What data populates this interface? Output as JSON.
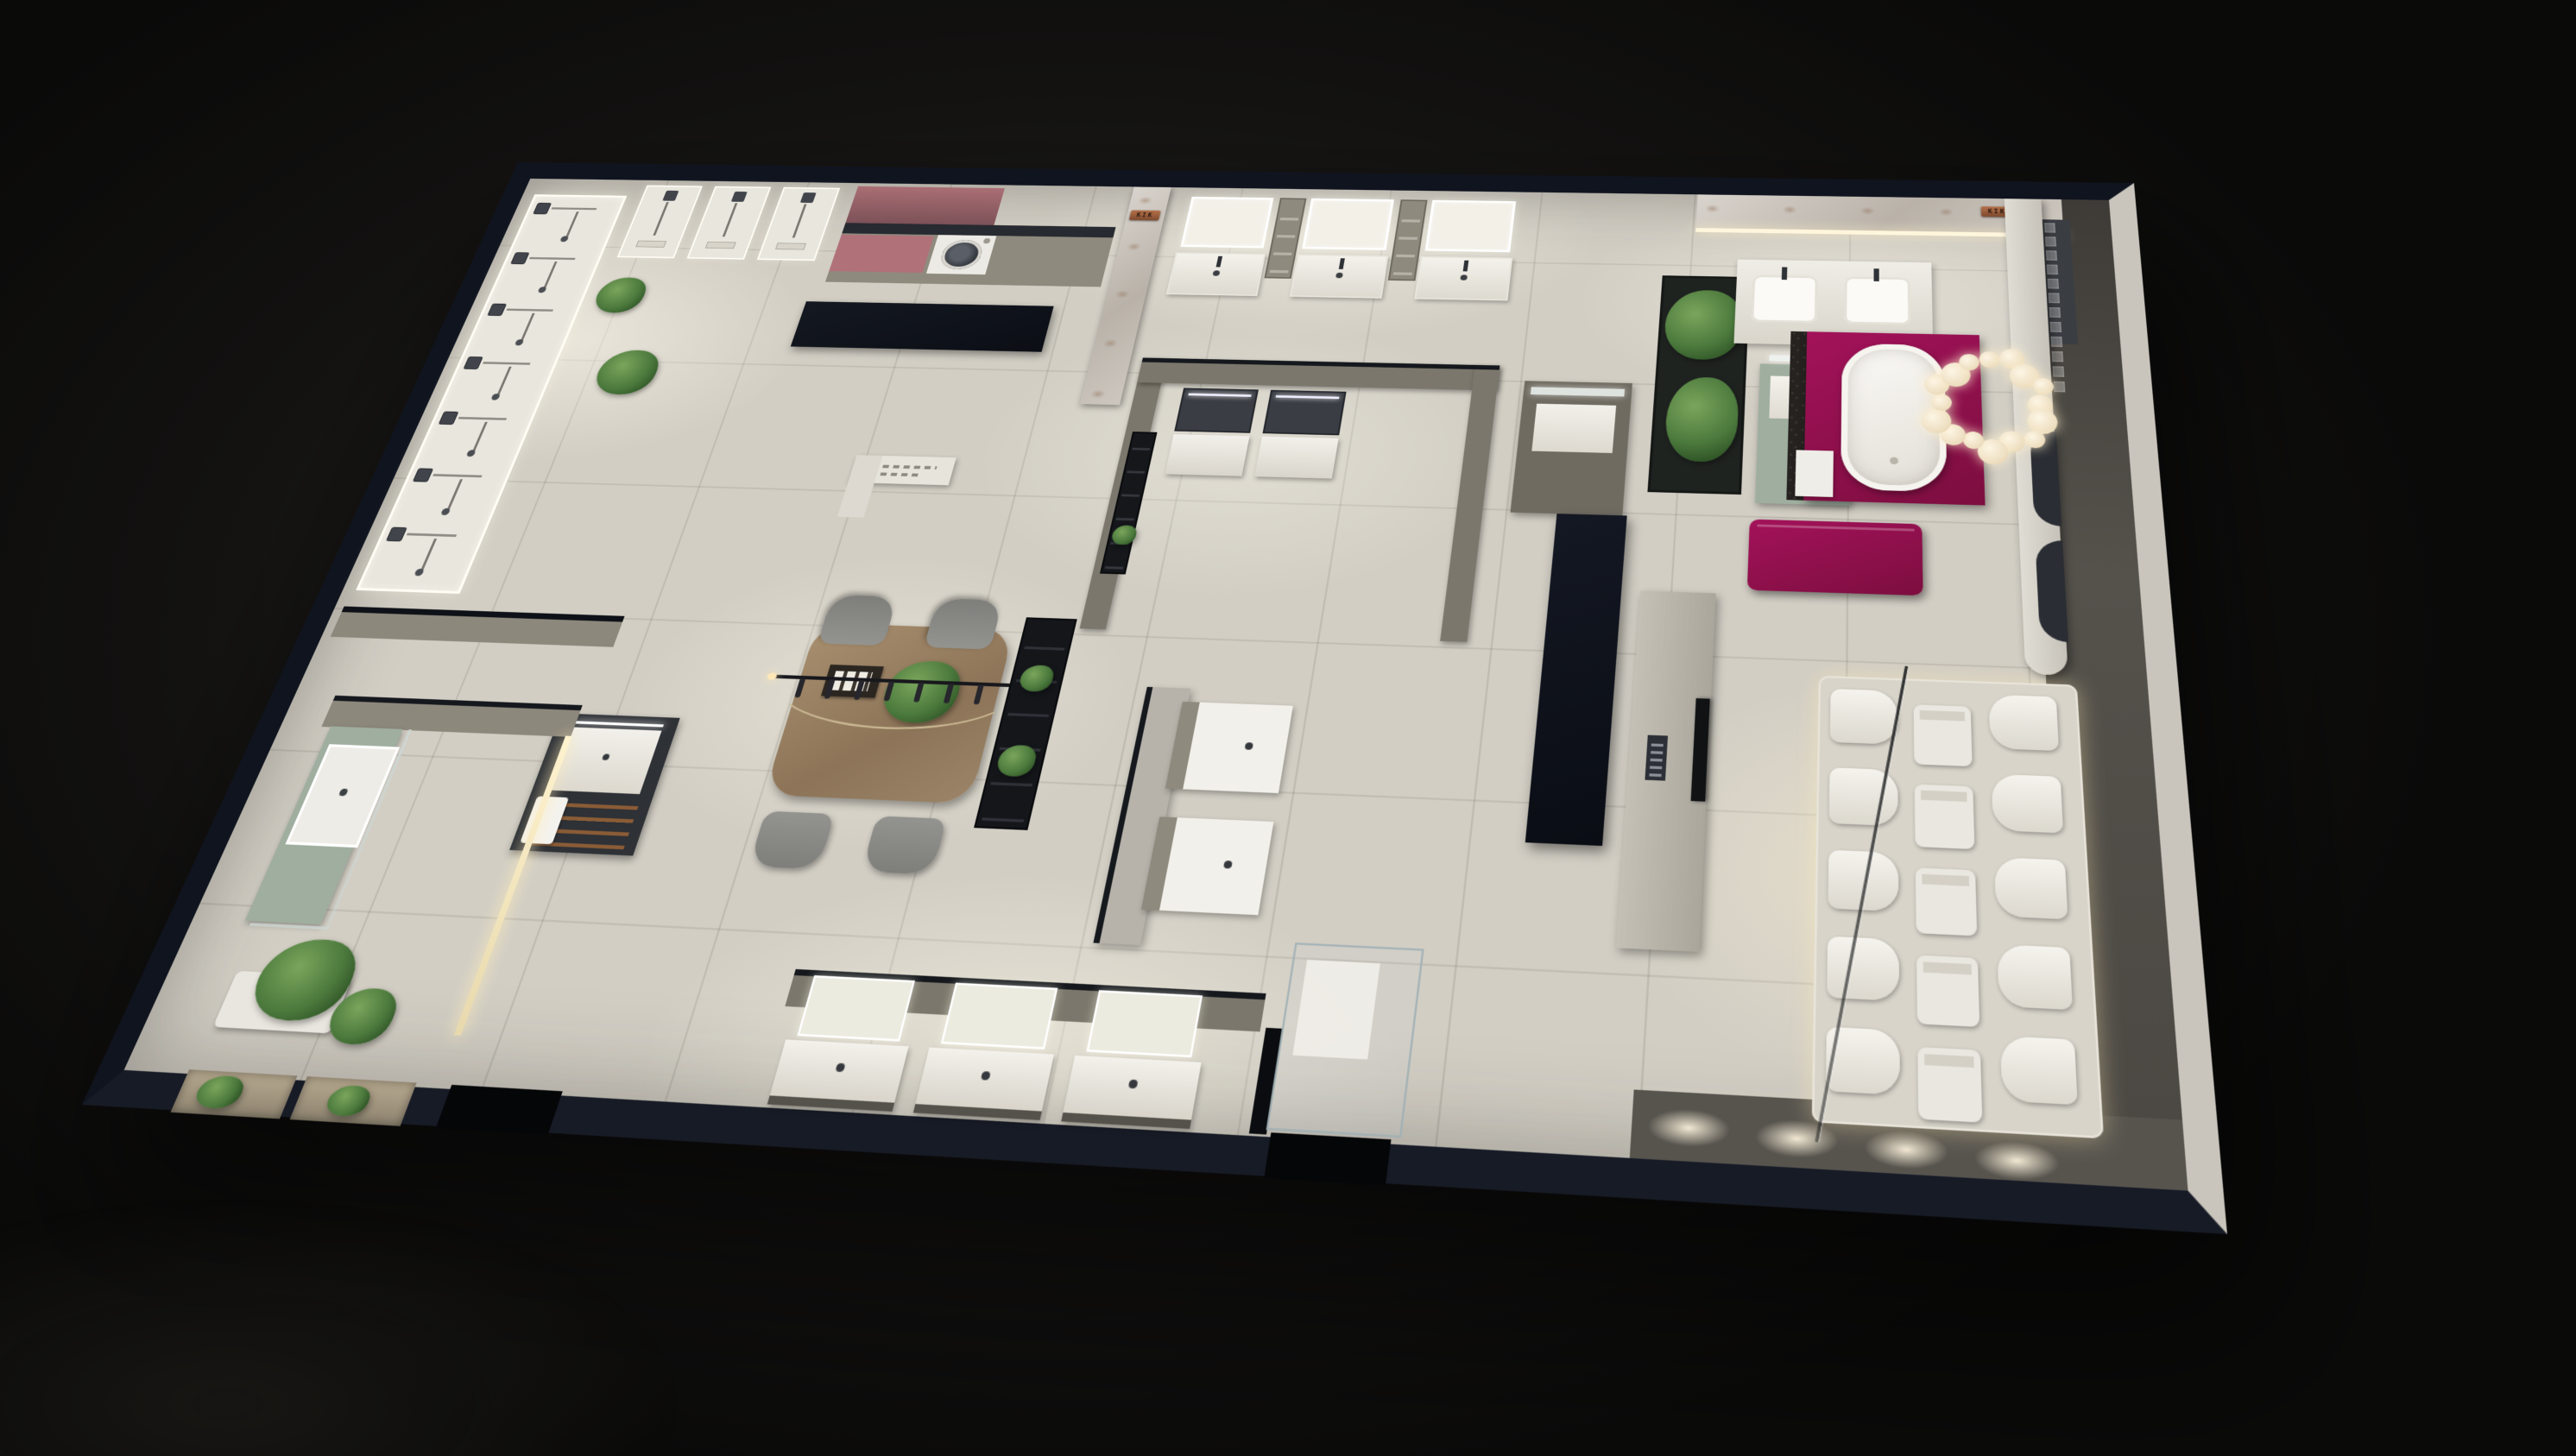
{
  "scene": {
    "description": "Top-down 3D night render of a KIK bathroom fixtures showroom floor plan",
    "brand_signs": [
      {
        "id": "stone-wall-sign",
        "text": "KIK"
      },
      {
        "id": "marble-wall-sign",
        "text": "KIK"
      }
    ],
    "palette": {
      "background": "#141312",
      "wall_navy": "#10141f",
      "wall_outer_light": "#c9c5bc",
      "floor_light": "#d2cec4",
      "floor_dark": "#534f49",
      "partition_taupe": "#7b776c",
      "counter_black": "#0d1117",
      "magenta": "#8e1048",
      "dusty_pink": "#b07179",
      "sage": "#9fae9f",
      "wood": "#9b8468",
      "copper": "#9a5d3c",
      "led_warm": "#ffeec6",
      "led_white": "#ffffff",
      "plant_green": "#4c7a3d",
      "marble_light": "#cfc9c2",
      "charcoal": "#2e3136",
      "porcelain": "#f2f0ea",
      "glass_tint": "#aebec2",
      "tv_black": "#101214"
    },
    "fixtures": {
      "shower_panels_left_wall": 7,
      "shower_panels_top_wall": 3,
      "top_vanity_units": 3,
      "gray_room_vanities": 2,
      "island_vanities": 2,
      "bottom_vanity_units": 3,
      "toilet_rows": 5,
      "toilet_columns": 3,
      "chandelier_bulbs": 16,
      "dining_chairs": 4,
      "lamp_hooks": 7,
      "floor_light_pools": 4,
      "glass_brick_rows": 8,
      "glass_brick_cols": 3
    }
  }
}
